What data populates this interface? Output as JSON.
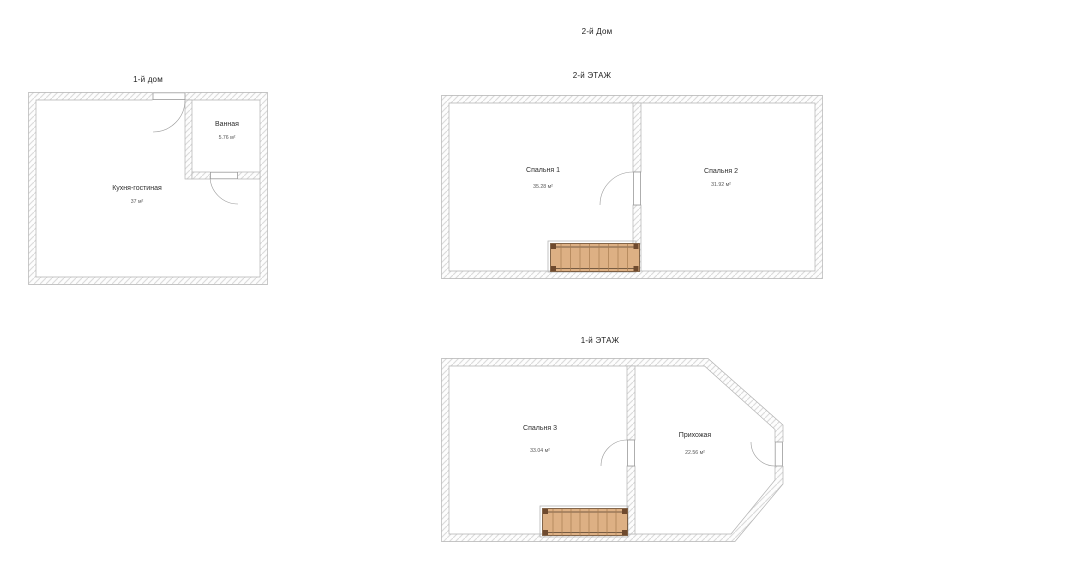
{
  "page": {
    "title": "2-й Дом"
  },
  "plans": {
    "house1": {
      "title": "1-й дом",
      "rooms": {
        "bathroom": {
          "name": "Ванная",
          "area": "5.76 м²"
        },
        "kitchen": {
          "name": "Кухня-гостиная",
          "area": "37 м²"
        }
      }
    },
    "floor2": {
      "title": "2-й ЭТАЖ",
      "rooms": {
        "bedroom1": {
          "name": "Спальня 1",
          "area": "35.28 м²"
        },
        "bedroom2": {
          "name": "Спальня 2",
          "area": "31.92 м²"
        }
      }
    },
    "floor1": {
      "title": "1-й ЭТАЖ",
      "rooms": {
        "bedroom3": {
          "name": "Спальня 3",
          "area": "33.04 м²"
        },
        "hallway": {
          "name": "Прихожая",
          "area": "22.56 м²"
        }
      }
    }
  },
  "colors": {
    "wall_hatch": "#dadada",
    "wall_stroke": "#b3b3b3",
    "stair_fill": "#ddb084",
    "stair_dark": "#6f4a2e",
    "text": "#2e2e2e"
  }
}
